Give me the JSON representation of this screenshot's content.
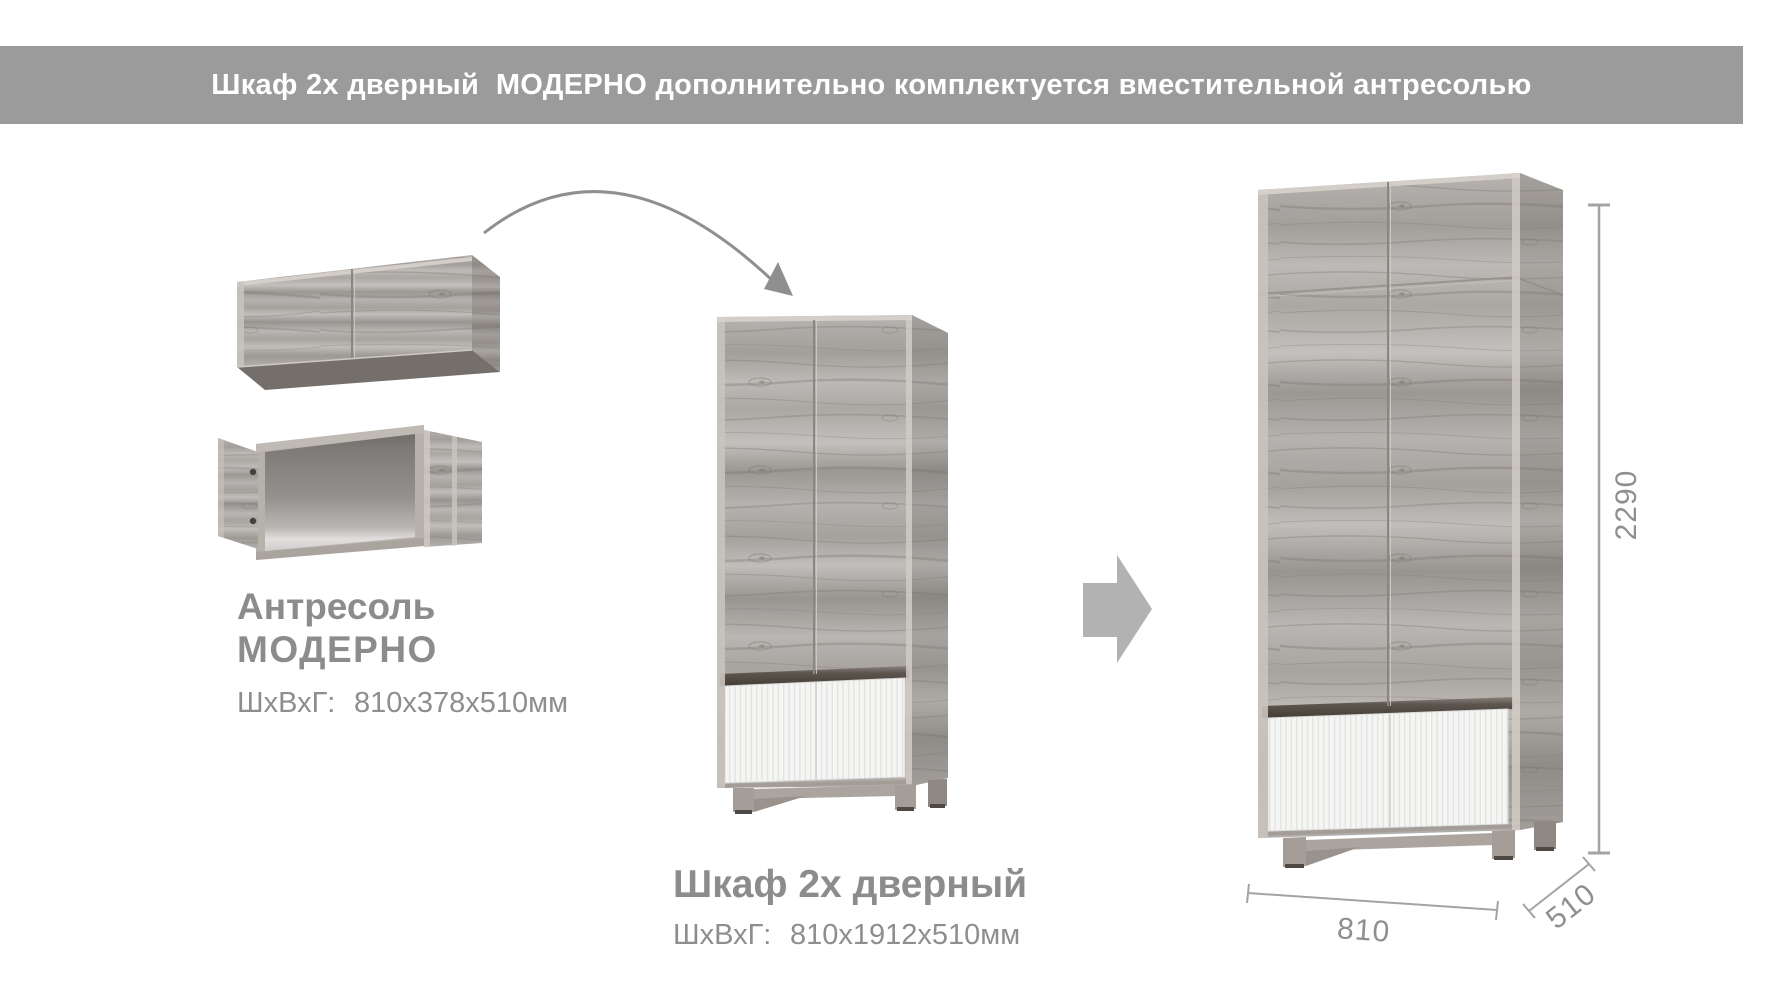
{
  "banner": {
    "title": "Шкаф 2х дверный  МОДЕРНО дополнительно комплектуется вместительной антресолью"
  },
  "antresol_block": {
    "name_line1": "Антресоль",
    "name_line2": "МОДЕРНО",
    "dims_label": "ШхВхГ:",
    "dims_value": "810х378х510мм"
  },
  "wardrobe_block": {
    "title": "Шкаф 2х дверный",
    "dims_label": "ШхВхГ:",
    "dims_value": "810х1912х510мм"
  },
  "dimensions": {
    "height_mm": "2290",
    "width_mm": "810",
    "depth_mm": "510"
  },
  "icons": {
    "curved_arrow": "curved-arrow-icon",
    "combine_arrow": "right-arrow-icon"
  },
  "colors": {
    "banner_bg": "#9b9b9b",
    "banner_text": "#ffffff",
    "label_gray": "#8c8c8c",
    "dimension_gray": "#a3a3a3",
    "arrow_gray": "#b2b2b2",
    "wood_base": "#b3afac",
    "white_panel": "#f5f5f4",
    "dark_strip": "#55504a"
  }
}
